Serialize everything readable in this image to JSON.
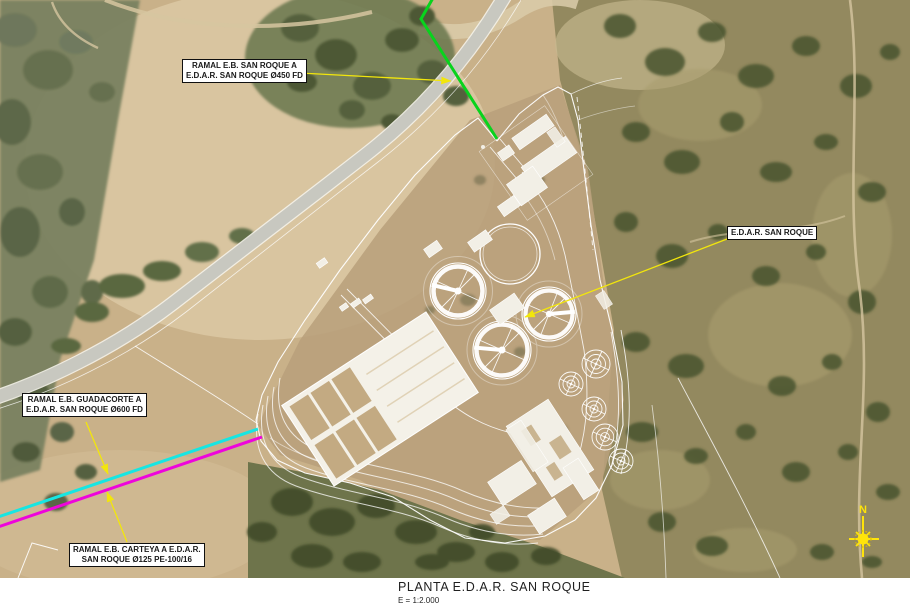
{
  "map": {
    "labels": {
      "ramal_san_roque": {
        "line1": "RAMAL E.B. SAN ROQUE A",
        "line2": "E.D.A.R. SAN ROQUE Ø450 FD"
      },
      "edar": {
        "line1": "E.D.A.R. SAN ROQUE",
        "line2": ""
      },
      "ramal_guadacorte": {
        "line1": "RAMAL E.B. GUADACORTE A",
        "line2": "E.D.A.R. SAN ROQUE Ø600 FD"
      },
      "ramal_carteya": {
        "line1": "RAMAL E.B. CARTEYA A E.D.A.R.",
        "line2": "SAN ROQUE Ø125 PE-100/16"
      }
    },
    "compass": {
      "north_label": "N"
    },
    "pipeline_colors": {
      "san_roque_ramal": "#08d31d",
      "guadacorte_ramal": "#17e6e2",
      "carteya_ramal": "#ee04dc",
      "leader": "#f2e60c",
      "compass": "#ffe40a"
    }
  },
  "footer": {
    "title": "PLANTA E.D.A.R. SAN ROQUE",
    "scale": "E = 1:2.000"
  }
}
